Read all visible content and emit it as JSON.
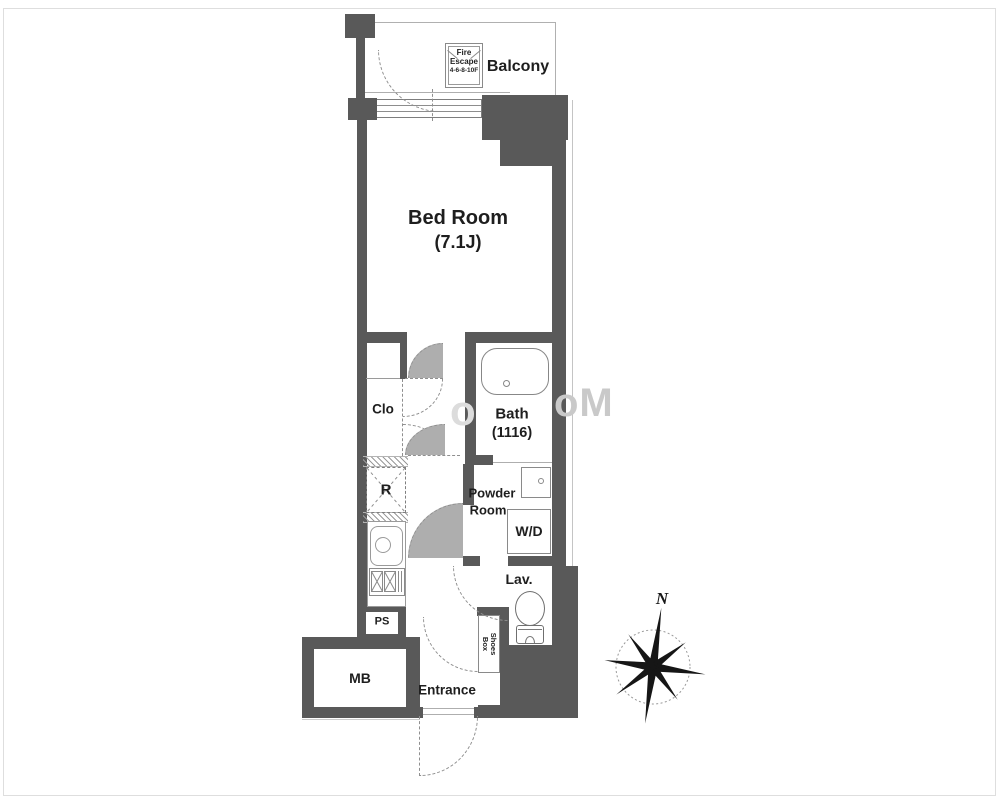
{
  "colors": {
    "wall": "#595959",
    "text": "#1e1e1e"
  },
  "rooms": {
    "balcony": "Balcony",
    "fire_escape": {
      "l1": "Fire",
      "l2": "Escape",
      "l3": "4-6-8-10F"
    },
    "bedroom": {
      "name": "Bed Room",
      "size": "(7.1J)"
    },
    "closet": "Clo",
    "bath": {
      "name": "Bath",
      "size": "(1116)"
    },
    "refrigerator": "R",
    "powder": {
      "l1": "Powder",
      "l2": "Room"
    },
    "washer_dryer": "W/D",
    "lavatory": "Lav.",
    "pipe_space": "PS",
    "meter_box": "MB",
    "shoes_box": {
      "l1": "Shoes",
      "l2": "Box"
    },
    "entrance": "Entrance"
  },
  "compass": {
    "north": "N"
  },
  "watermark": {
    "p1": "o",
    "p2": "oM"
  }
}
